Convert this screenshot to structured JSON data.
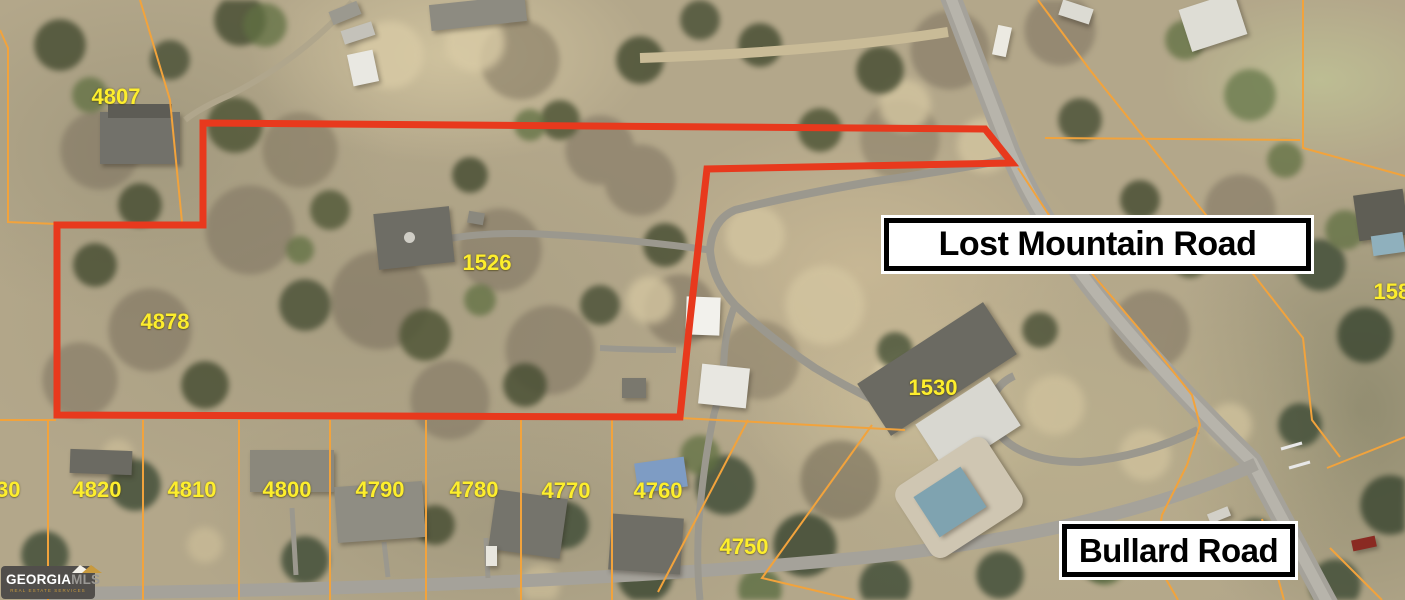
{
  "map": {
    "red_boundary_points": "203,123 985,129 1012,163 707,169 690,320 680,417 57,415 57,225 203,225",
    "parcel_lines": [
      "M140,0 L170,100 L182,222",
      "M0,30 L8,48 L8,222 L57,224",
      "M0,420 L56,420",
      "M48,420 L48,600",
      "M143,420 L143,600",
      "M239,420 L239,600",
      "M330,420 L330,600",
      "M426,420 L426,600",
      "M521,420 L521,600",
      "M612,420 L612,600",
      "M680,418 L905,430",
      "M748,420 L658,592",
      "M872,425 L762,578 L855,600",
      "M1018,168 L1072,250 L1140,330 L1192,395 L1200,425 L1187,465 L1162,515 L1155,560 L1178,600",
      "M1038,0 L1090,70 L1170,170 L1250,270 L1303,338 L1312,420 L1340,457",
      "M1045,138 L1300,140",
      "M1303,0 L1303,148 L1405,176",
      "M1327,468 L1405,437",
      "M1262,519 L1284,600",
      "M1330,548 L1382,600"
    ],
    "parcel_labels": [
      {
        "label": "4807",
        "x": 116,
        "y": 97
      },
      {
        "label": "1526",
        "x": 487,
        "y": 263
      },
      {
        "label": "4878",
        "x": 165,
        "y": 322
      },
      {
        "label": "4830",
        "x": -4,
        "y": 490
      },
      {
        "label": "4820",
        "x": 97,
        "y": 490
      },
      {
        "label": "4810",
        "x": 192,
        "y": 490
      },
      {
        "label": "4800",
        "x": 287,
        "y": 490
      },
      {
        "label": "4790",
        "x": 380,
        "y": 490
      },
      {
        "label": "4780",
        "x": 474,
        "y": 490
      },
      {
        "label": "4770",
        "x": 566,
        "y": 491
      },
      {
        "label": "4760",
        "x": 658,
        "y": 491
      },
      {
        "label": "4750",
        "x": 744,
        "y": 547
      },
      {
        "label": "1530",
        "x": 933,
        "y": 388
      },
      {
        "label": "1580",
        "x": 1398,
        "y": 292
      }
    ],
    "colors": {
      "boundary_red": "#e8391d",
      "parcel_orange": "#f2a33c",
      "label_yellow": "#fdee2d"
    }
  },
  "road_signs": {
    "lost_mountain": "Lost Mountain Road",
    "bullard": "Bullard Road"
  },
  "logo": {
    "georgia": "GEORGIA",
    "mls": "MLS",
    "tagline": "REAL ESTATE SERVICES"
  }
}
